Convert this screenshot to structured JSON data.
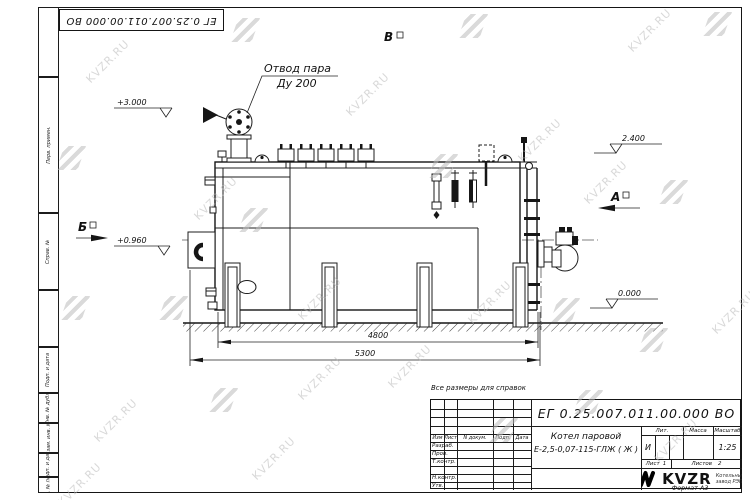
{
  "watermark": {
    "text": "KVZR.RU"
  },
  "corner_stamp": {
    "doc_number": "ЕГ 0.25.007.011.00.000  ВО"
  },
  "margin_labels": [
    "Перв. примен.",
    "Справ. №",
    "Подп. и дата",
    "Инв. № дубл.",
    "Взам. инв. №",
    "Подп. и дата",
    "Инв. № подл."
  ],
  "note": "Все размеры для справок",
  "drawing": {
    "callout_line1": "Отвод пара",
    "callout_line2": "Ду 200",
    "elevation_top": "+3.000",
    "elevation_burner": "+0.960",
    "elevation_deck": "2.400",
    "elevation_ground": "0.000",
    "dim_inner": "4800",
    "dim_overall": "5300",
    "view_a": "А",
    "view_b": "Б",
    "view_v": "В"
  },
  "title_block": {
    "doc_number": "ЕГ 0.25.007.011.00.000  ВО",
    "product_line1": "Котел паровой",
    "product_line2": "Е-2,5-0,07-115-ГЛЖ ( Ж )",
    "col_izm": "Изм",
    "col_list": "Лист",
    "col_ndoc": "N докум.",
    "col_podp": "Подп.",
    "col_data": "Дата",
    "row_razrab": "Разраб.",
    "row_prov": "Пров.",
    "row_tkontr": "Т.контр.",
    "row_nkontr": "Н.контр.",
    "row_utv": "Утв.",
    "lit_label": "Лит.",
    "mass_label": "Масса",
    "scale_label": "Масштаб",
    "lit_value": "И",
    "scale_value": "1:25",
    "sheet_label": "Лист",
    "sheet_value": "1",
    "sheets_label": "Листов",
    "sheets_value": "2",
    "company_name": "KVZR",
    "company_sub1": "Котельный",
    "company_sub2": "завод РЭП",
    "format_label": "Формат А3"
  }
}
